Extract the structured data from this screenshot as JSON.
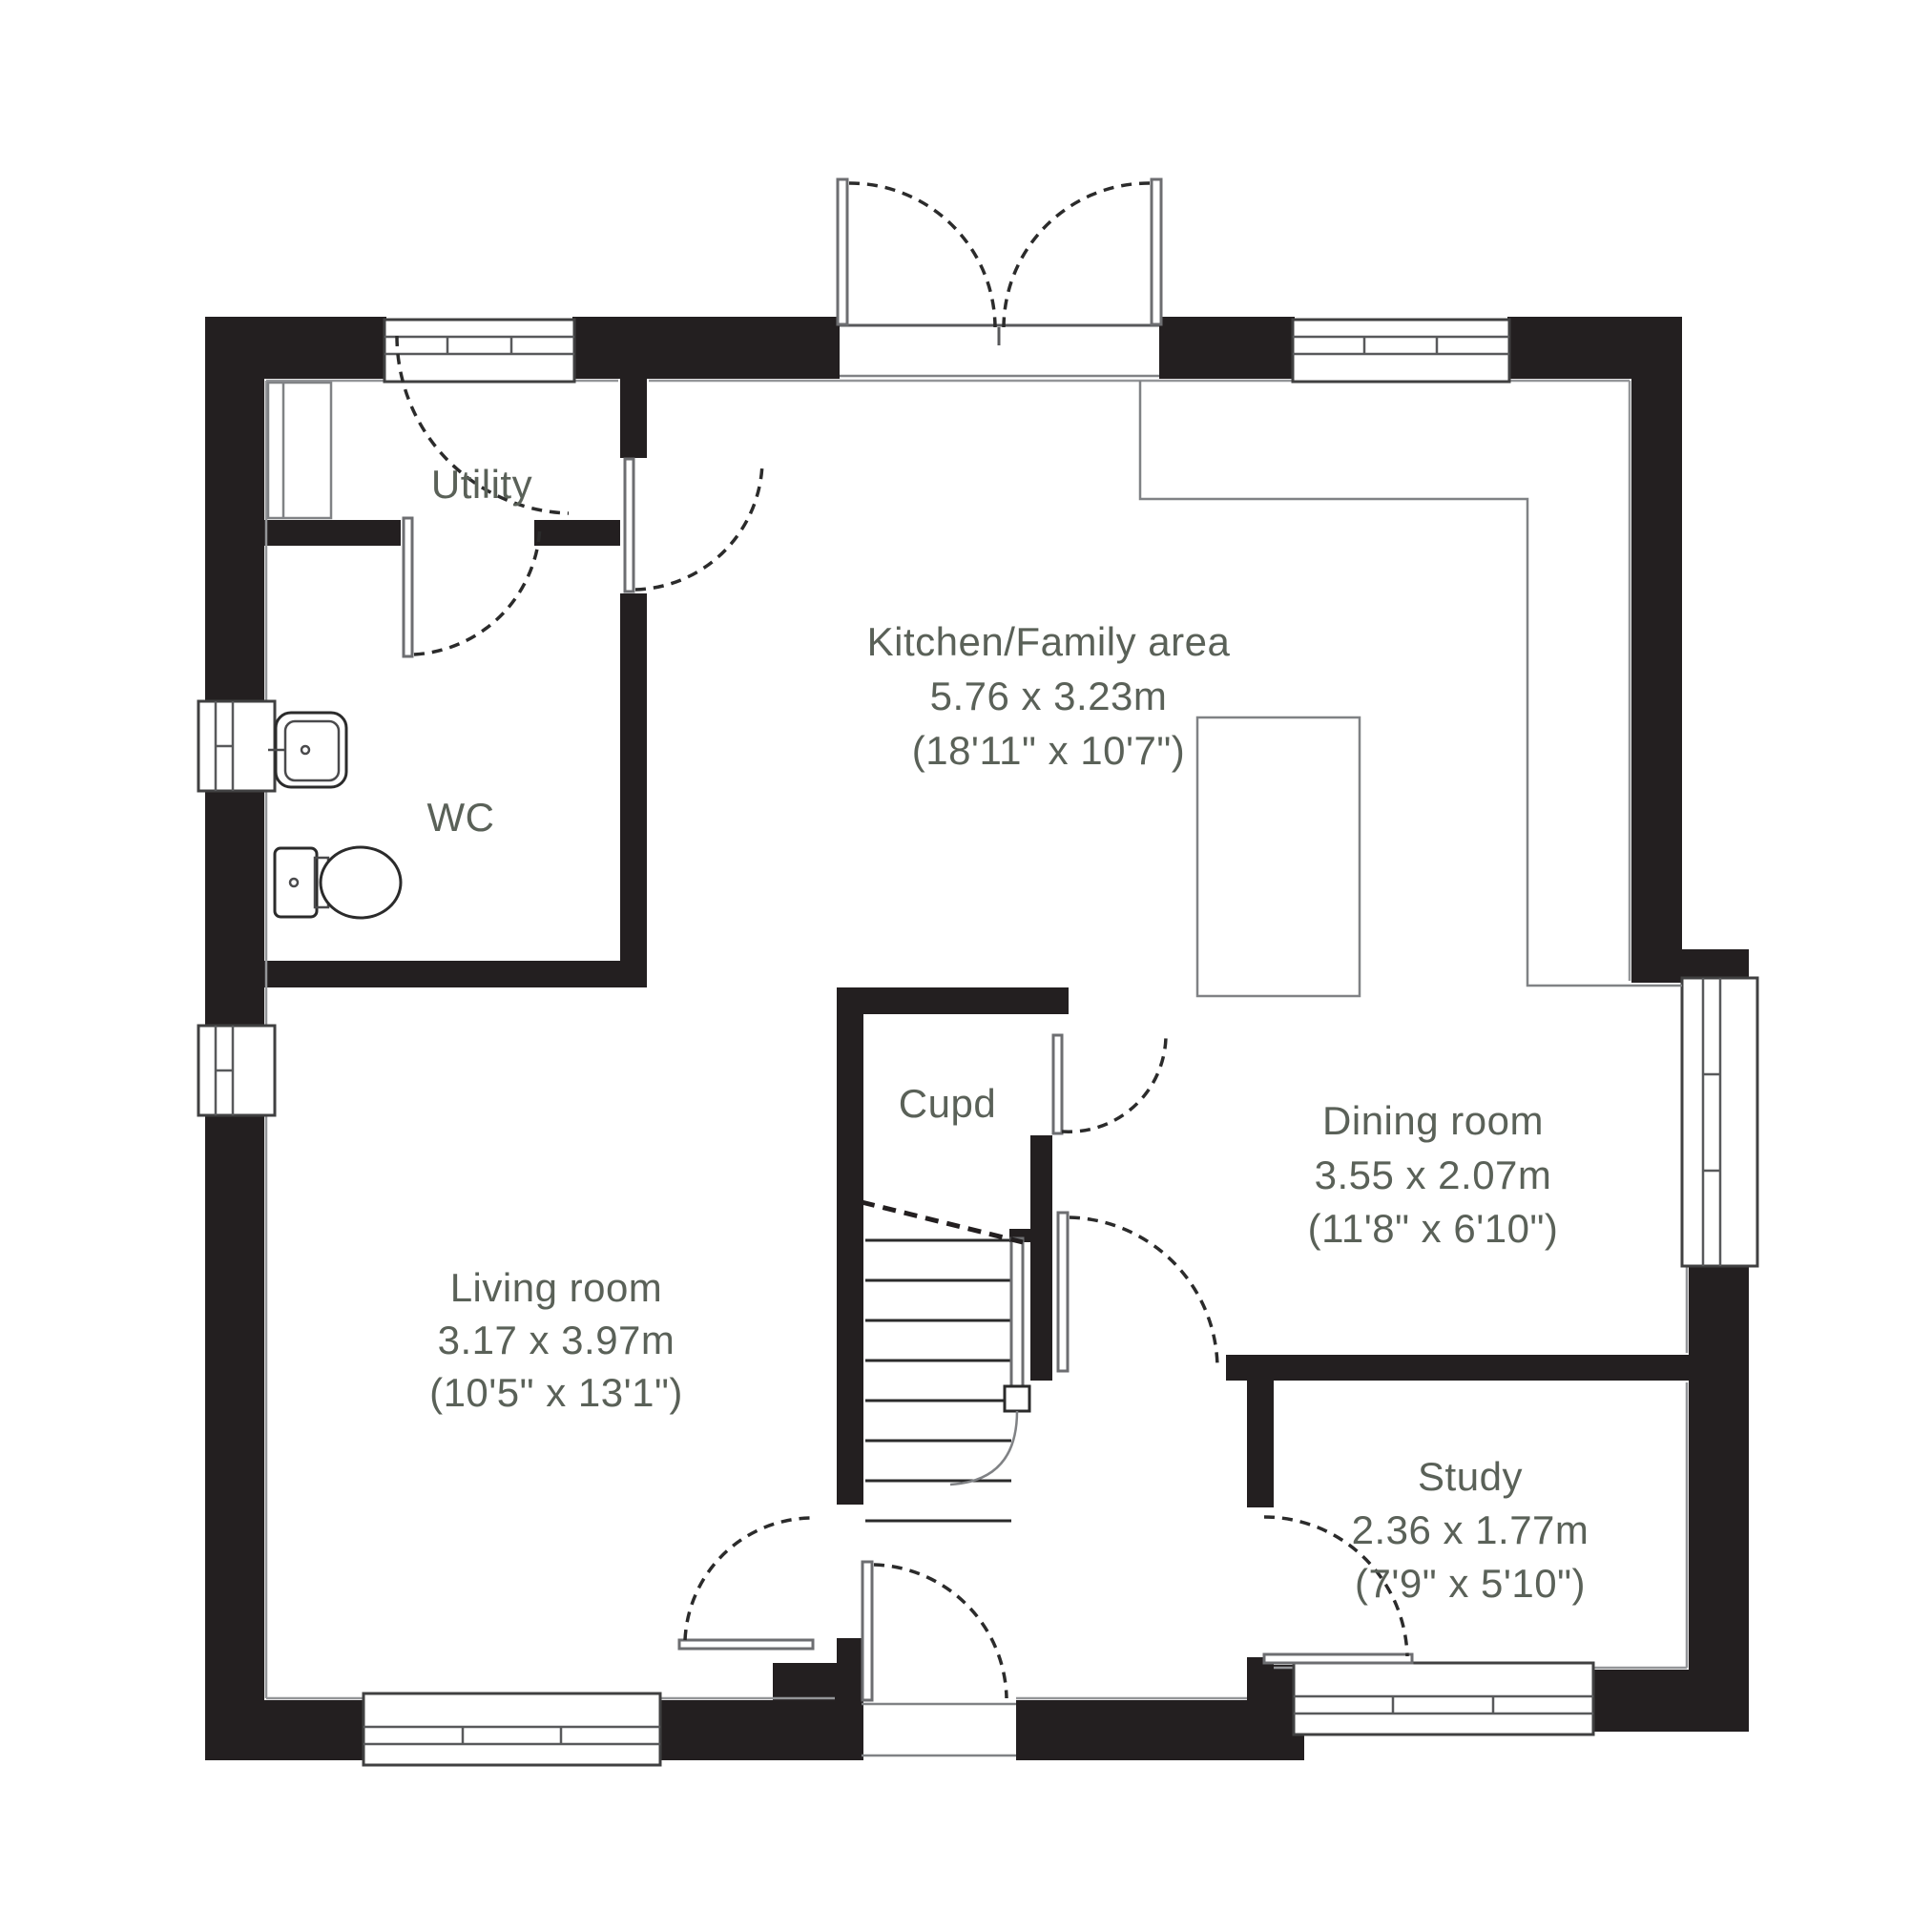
{
  "plan": {
    "title": "Ground floor plan",
    "rooms": [
      {
        "id": "utility",
        "label": "Utility"
      },
      {
        "id": "wc",
        "label": "WC"
      },
      {
        "id": "kitchen",
        "label": "Kitchen/Family area",
        "dim_metric": "5.76 x 3.23m",
        "dim_imperial": "(18'11\" x 10'7\")"
      },
      {
        "id": "cupd",
        "label": "Cupd"
      },
      {
        "id": "living",
        "label": "Living room",
        "dim_metric": "3.17 x 3.97m",
        "dim_imperial": "(10'5\" x 13'1\")"
      },
      {
        "id": "dining",
        "label": "Dining room",
        "dim_metric": "3.55 x 2.07m",
        "dim_imperial": "(11'8\" x 6'10\")"
      },
      {
        "id": "study",
        "label": "Study",
        "dim_metric": "2.36 x 1.77m",
        "dim_imperial": "(7'9\" x 5'10\")"
      }
    ],
    "colors": {
      "wall": "#231f20",
      "line": "#58595b",
      "text": "#5a6158",
      "background": "#ffffff"
    }
  }
}
